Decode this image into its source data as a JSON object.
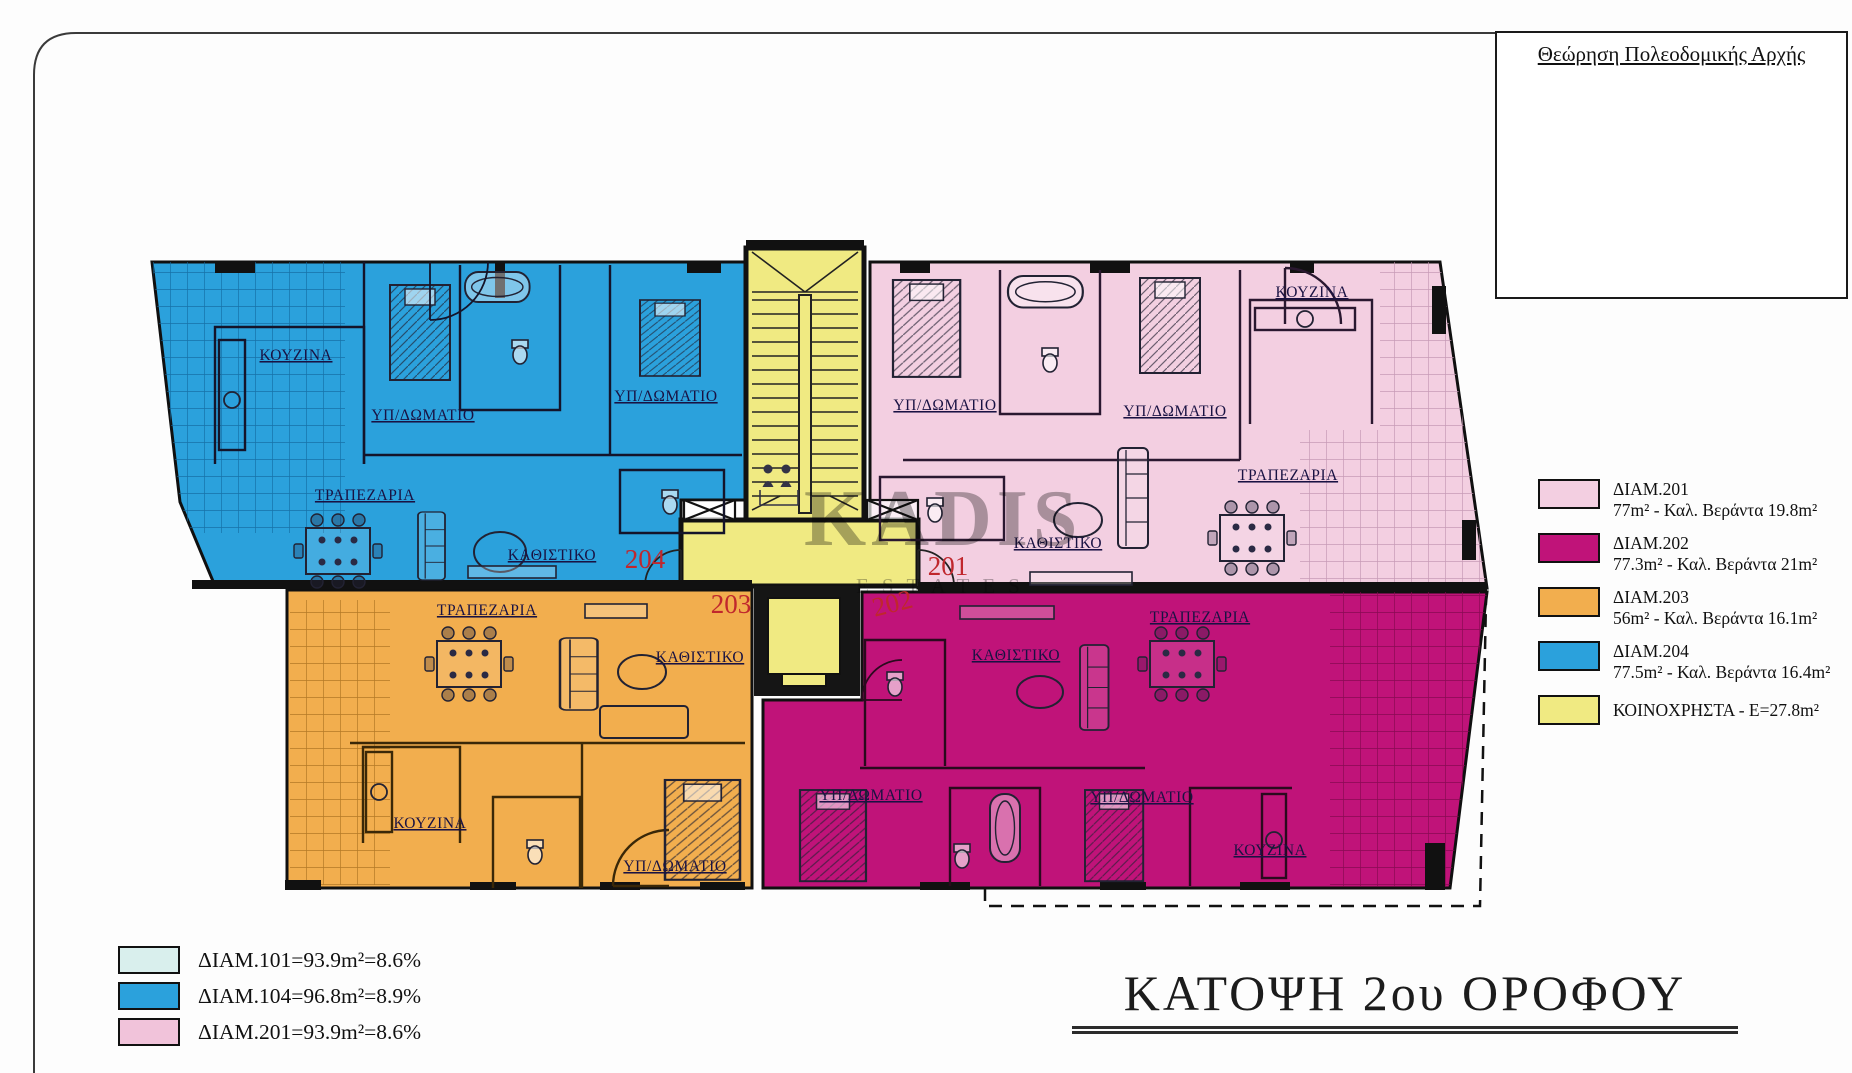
{
  "approval_box": {
    "title": "Θεώρηση Πολεοδομικής Αρχής"
  },
  "title": "ΚΑΤΟΨΗ 2ου ΟΡΟΦΟΥ",
  "watermark": {
    "line1": "KADIS",
    "line2": "ESTATES"
  },
  "legend_right": {
    "items": [
      {
        "line1": "ΔΙΑΜ.201",
        "line2": "77m² - Καλ. Βεράντα 19.8m²",
        "color": "#f3cfe1"
      },
      {
        "line1": "ΔΙΑΜ.202",
        "line2": "77.3m² - Καλ. Βεράντα 21m²",
        "color": "#c01379"
      },
      {
        "line1": "ΔΙΑΜ.203",
        "line2": "56m² - Καλ. Βεράντα 16.1m²",
        "color": "#f2ae4e"
      },
      {
        "line1": "ΔΙΑΜ.204",
        "line2": "77.5m² - Καλ. Βεράντα 16.4m²",
        "color": "#2ba1dc"
      },
      {
        "line1": "ΚΟΙΝΟΧΡΗΣΤΑ - Ε=27.8m²",
        "line2": "",
        "color": "#f0ea82"
      }
    ]
  },
  "legend_bottom": {
    "items": [
      {
        "label": "ΔΙΑΜ.101=93.9m²=8.6%",
        "color": "#d9efed"
      },
      {
        "label": "ΔΙΑΜ.104=96.8m²=8.9%",
        "color": "#2ba1dc"
      },
      {
        "label": "ΔΙΑΜ.201=93.9m²=8.6%",
        "color": "#f1c3da"
      }
    ]
  },
  "plan": {
    "units": [
      {
        "id": "204",
        "color": "#2ba1dc",
        "rooms": {
          "kitchen": "ΚΟΥΖΙΝΑ",
          "bedroom1": "ΥΠ/ΔΩΜΑΤΙΟ",
          "bedroom2": "ΥΠ/ΔΩΜΑΤΙΟ",
          "dining": "ΤΡΑΠΕΖΑΡΙΑ",
          "living": "ΚΑΘΙΣΤΙΚΟ"
        }
      },
      {
        "id": "201",
        "color": "#f3cfe1",
        "rooms": {
          "kitchen": "ΚΟΥΖΙΝΑ",
          "bedroom1": "ΥΠ/ΔΩΜΑΤΙΟ",
          "bedroom2": "ΥΠ/ΔΩΜΑΤΙΟ",
          "dining": "ΤΡΑΠΕΖΑΡΙΑ",
          "living": "ΚΑΘΙΣΤΙΚΟ"
        }
      },
      {
        "id": "203",
        "color": "#f2ae4e",
        "rooms": {
          "kitchen": "ΚΟΥΖΙΝΑ",
          "bedroom1": "ΥΠ/ΔΩΜΑΤΙΟ",
          "dining": "ΤΡΑΠΕΖΑΡΙΑ",
          "living": "ΚΑΘΙΣΤΙΚΟ"
        }
      },
      {
        "id": "202",
        "color": "#c01379",
        "rooms": {
          "kitchen": "ΚΟΥΖΙΝΑ",
          "bedroom1": "ΥΠ/ΔΩΜΑΤΙΟ",
          "bedroom2": "ΥΠ/ΔΩΜΑΤΙΟ",
          "dining": "ΤΡΑΠΕΖΑΡΙΑ",
          "living": "ΚΑΘΙΣΤΙΚΟ"
        }
      }
    ],
    "common_color": "#f0ea82",
    "number_color": "#c0272d"
  }
}
